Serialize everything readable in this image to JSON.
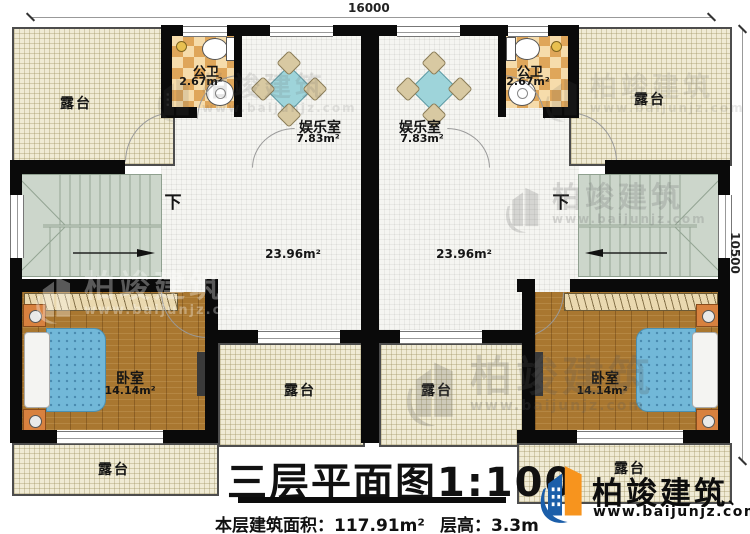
{
  "dimensions": {
    "top_width": "16000",
    "right_height": "10500"
  },
  "labels": {
    "terrace": "露台",
    "public_bath": "公卫",
    "public_bath_area": "2.67m²",
    "entertainment": "娱乐室",
    "entertainment_area": "7.83m²",
    "hall_area": "23.96m²",
    "bedroom": "卧室",
    "bedroom_area": "14.14m²",
    "stairs_down": "下"
  },
  "title_block": {
    "title": "三层平面图1:100",
    "area_text": "本层建筑面积：117.91m²",
    "height_text": "层高：3.3m"
  },
  "brand": {
    "name": "柏竣建筑",
    "mark": "、",
    "url": "www.baijunjz.com",
    "blue": "#1b5ea9",
    "orange": "#f7941e"
  },
  "watermark": {
    "name": "柏竣建筑",
    "url": "www.baijunjz.com"
  }
}
